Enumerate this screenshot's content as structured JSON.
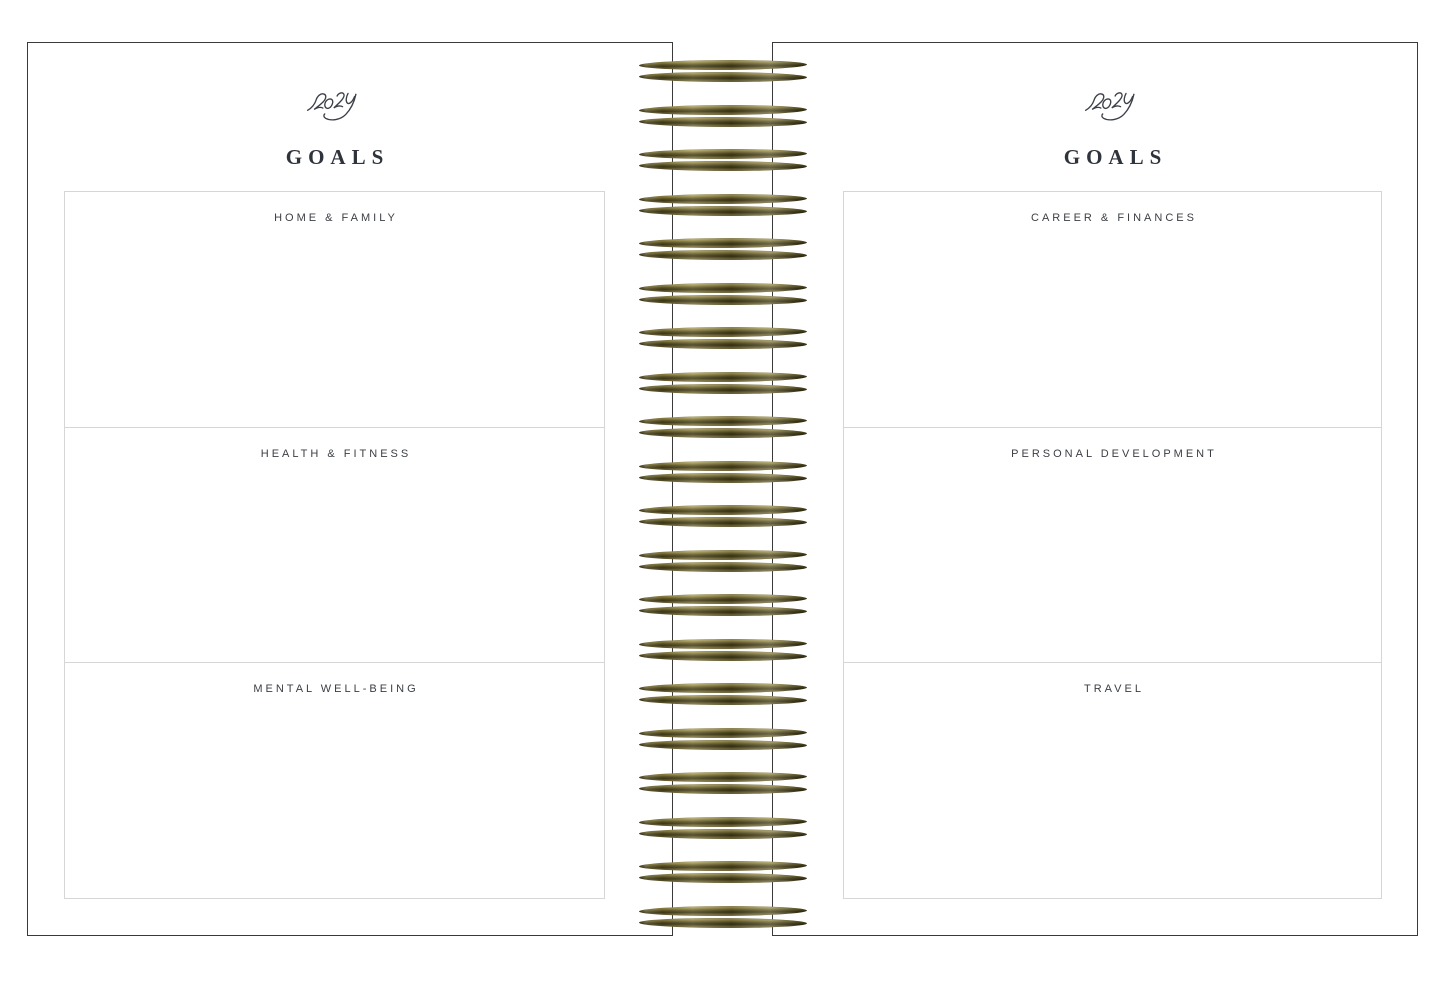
{
  "spread": {
    "left_page": {
      "year": "2024",
      "title": "GOALS",
      "sections": [
        {
          "label": "HOME & FAMILY"
        },
        {
          "label": "HEALTH & FITNESS"
        },
        {
          "label": "MENTAL WELL-BEING"
        }
      ]
    },
    "right_page": {
      "year": "2024",
      "title": "GOALS",
      "sections": [
        {
          "label": "CAREER & FINANCES"
        },
        {
          "label": "PERSONAL DEVELOPMENT"
        },
        {
          "label": "TRAVEL"
        }
      ]
    },
    "binding": {
      "coil_pairs": 20,
      "coil_color": "#6e6433"
    }
  }
}
